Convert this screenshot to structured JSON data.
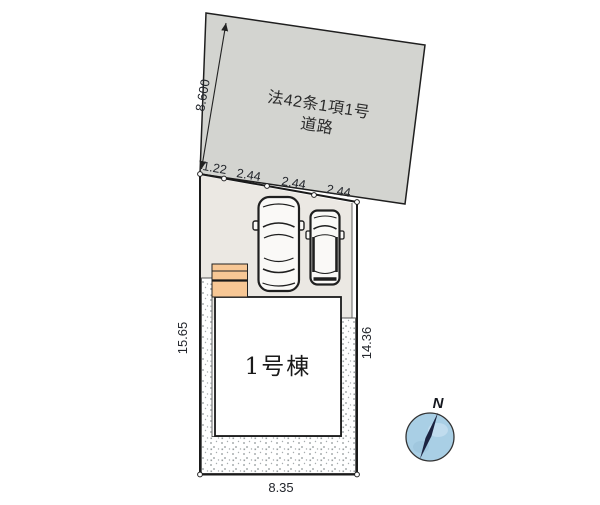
{
  "road": {
    "label_line1": "法42条1項1号",
    "label_line2": "道路",
    "depth_dim": "8.600"
  },
  "frontage": {
    "dims": [
      "1.22",
      "2.44",
      "2.44",
      "2.44"
    ]
  },
  "lot": {
    "left_dim": "15.65",
    "right_dim": "14.36",
    "bottom_dim": "8.35"
  },
  "building": {
    "label": "1号棟"
  },
  "compass": {
    "label": "N"
  },
  "colors": {
    "road_fill": "#d3d4d0",
    "parking_fill": "#ebe8e3",
    "building_fill": "#ffffff",
    "porch_fill": "#f7c795",
    "compass_fill": "#a9cfe5",
    "needle_color": "#1c2340",
    "line_color": "#1a1a1a"
  }
}
